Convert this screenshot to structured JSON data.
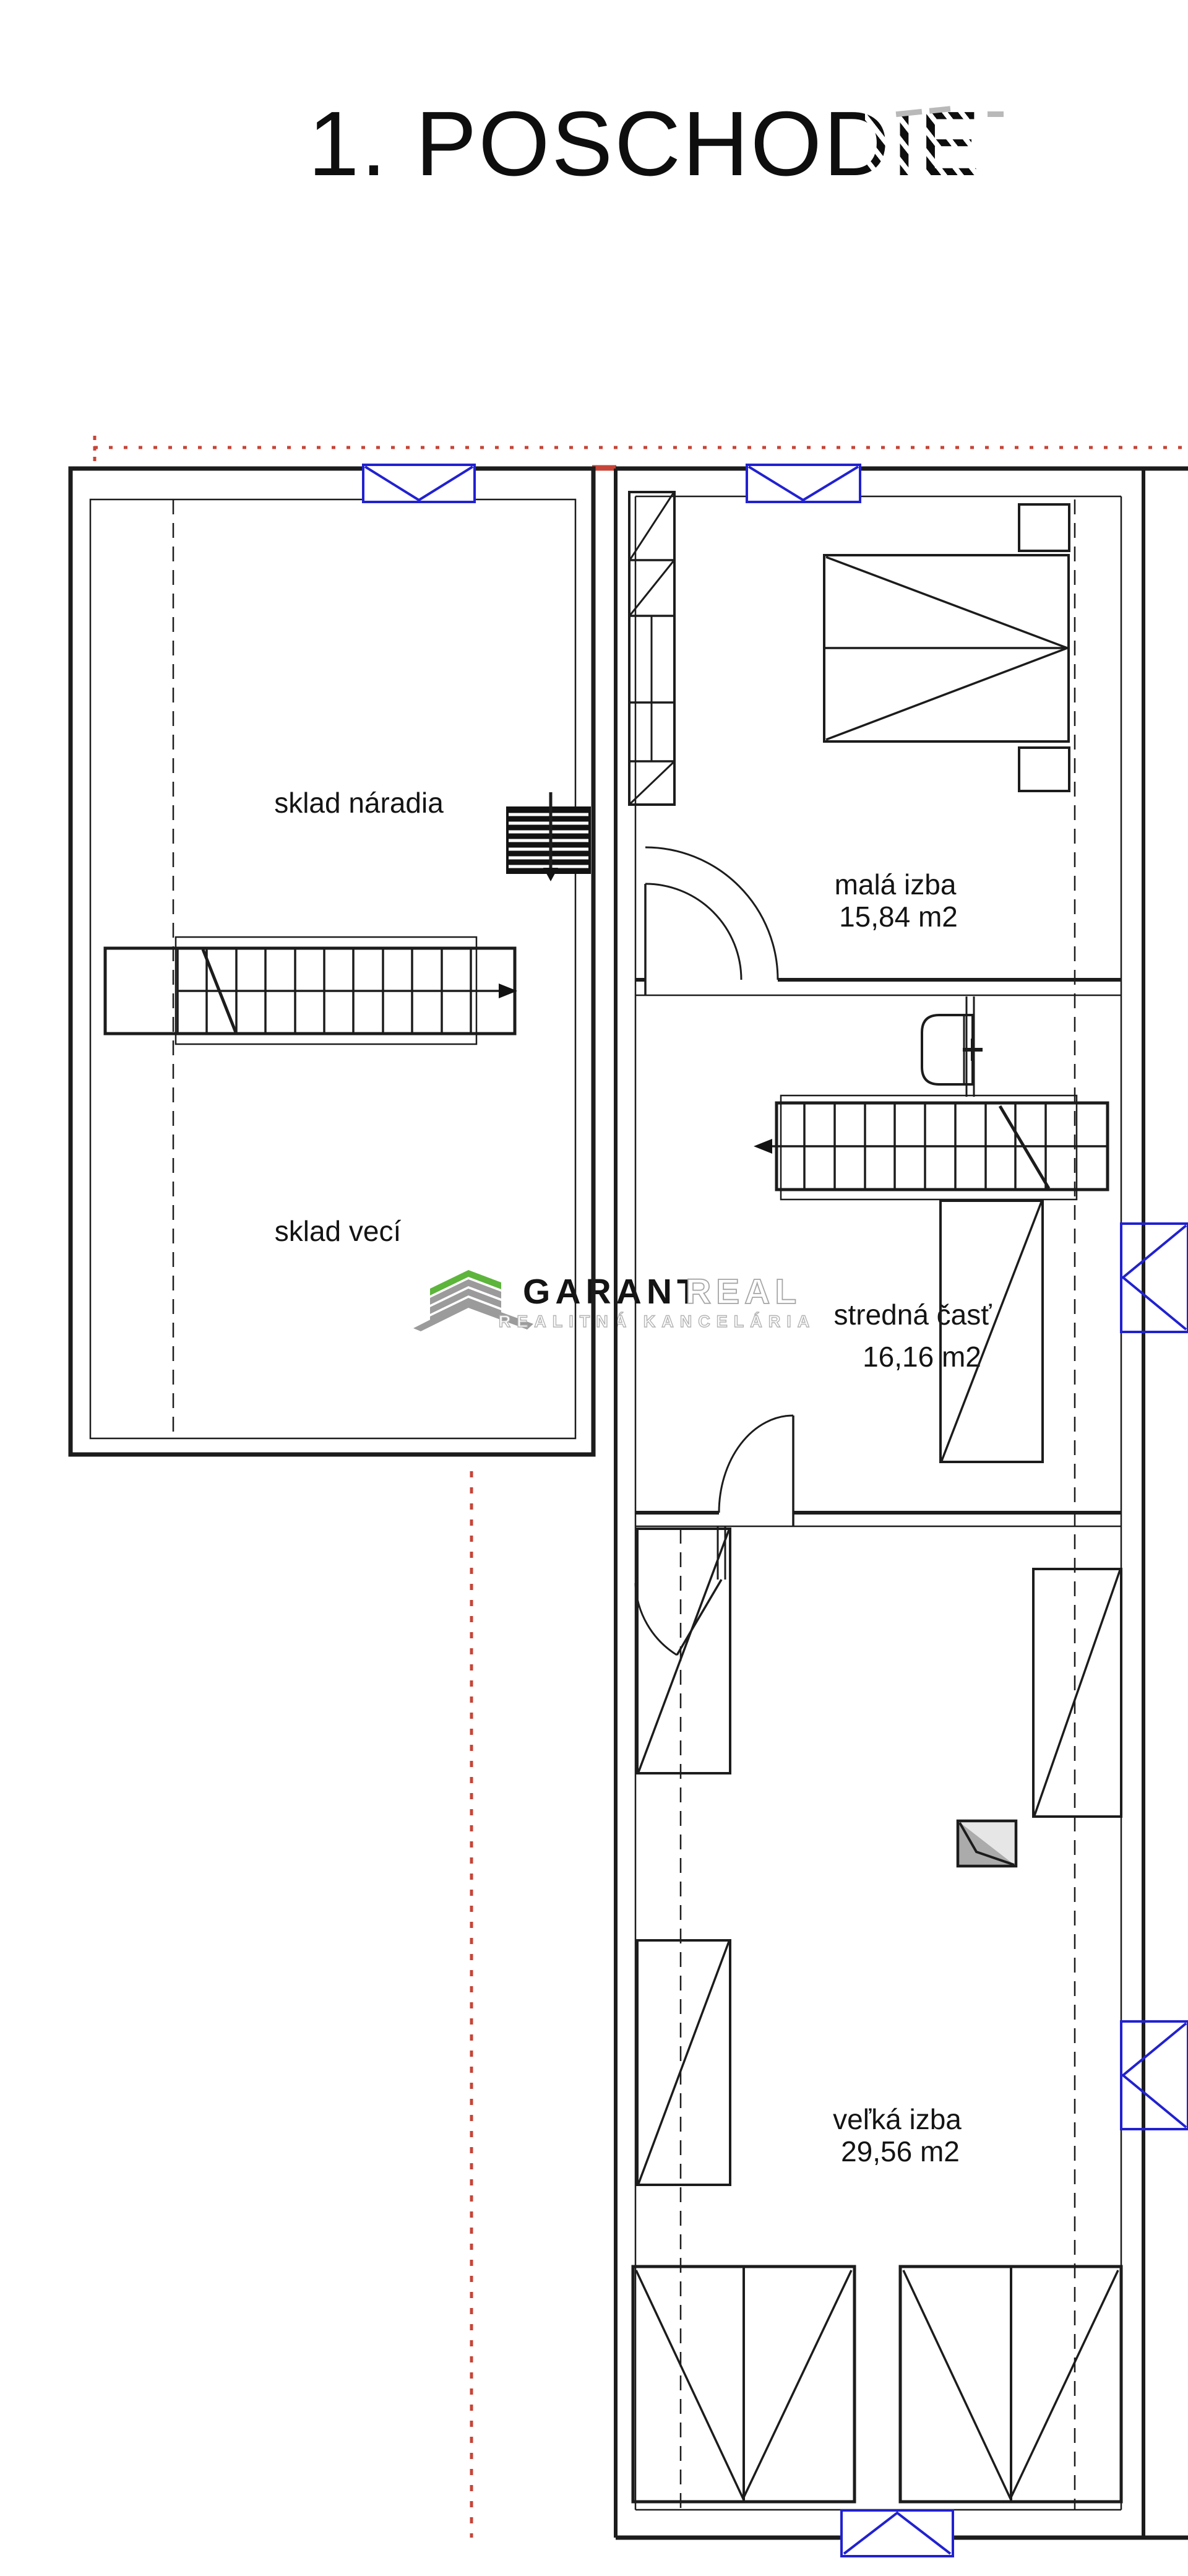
{
  "title": "1. POSCHODIE",
  "rooms": {
    "sklad_naradia": {
      "label": "sklad náradia"
    },
    "sklad_veci": {
      "label": "sklad vecí"
    },
    "mala_izba": {
      "label": "malá izba",
      "area": "15,84 m2"
    },
    "stredna_cast": {
      "label": "stredná časť",
      "area": "16,16 m2"
    },
    "velka_izba": {
      "label": "veľká izba",
      "area": "29,56 m2"
    }
  },
  "watermark": {
    "brand_primary": "GARANT",
    "brand_secondary": "REAL",
    "subtitle": "REALITNÁ KANCELÁRIA",
    "accent_color": "#5db53c",
    "gray_color": "#9b9b9b"
  },
  "colors": {
    "window_blue": "#2121d1",
    "guide_red": "#c64538",
    "line_black": "#1c1c1c"
  },
  "icons": {
    "window-icon": "blue rectangle with V diagonals",
    "radiator-icon": "black striped block with down arrow",
    "stairs-icon": "treads with direction arrow and break line",
    "door-swing-icon": "quarter-circle arc with leaf",
    "tv-icon": "gray split square",
    "logo-building-icon": "striped chevron building"
  }
}
